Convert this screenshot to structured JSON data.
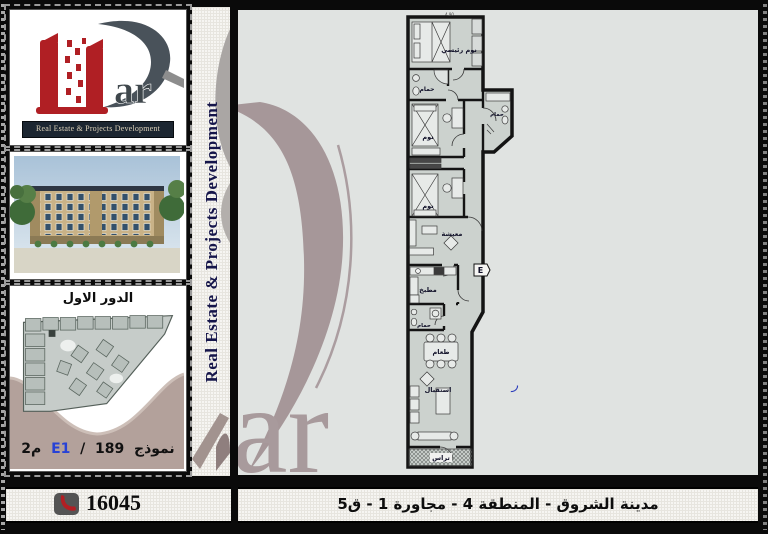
{
  "brand": {
    "logo_suffix": "ar",
    "banner": "Real Estate & Projects Development",
    "vertical_text": "Real Estate & Projects Development",
    "watermark_suffix": "ar"
  },
  "sidebar": {
    "floor_thumb": {
      "title": "الدور الاول",
      "model_label": "نموذج",
      "model_code": "E1",
      "separator": "/",
      "area_value": "189",
      "area_unit": "م2"
    }
  },
  "floor_plan": {
    "dimension_top": "4.90",
    "unit_letter": "E",
    "rooms": {
      "master_bedroom": "نوم رئيسي",
      "bathroom_1": "حمام",
      "bedroom_1": "نوم",
      "bathroom_2": "حمام",
      "bedroom_2": "نوم",
      "living": "معيشة",
      "kitchen": "مطبخ",
      "bathroom_3": "حمام",
      "dining": "طعام",
      "reception": "استقبال",
      "terrace": "تراس"
    },
    "stray_mark": "ر"
  },
  "footer": {
    "phone_number": "16045",
    "address": "مدينة الشروق - المنطقة 4 - مجاورة 1 - ق5"
  },
  "colors": {
    "brand_red": "#b01f24",
    "logo_slate": "#49525a",
    "watermark_taupe": "#a89a9c",
    "navy_text": "#15154a",
    "code_blue": "#2742d6",
    "panel_bg": "#e0e3e1",
    "plan_room_fill": "#ccd2ce",
    "thumb_tan": "#b3a19b"
  }
}
